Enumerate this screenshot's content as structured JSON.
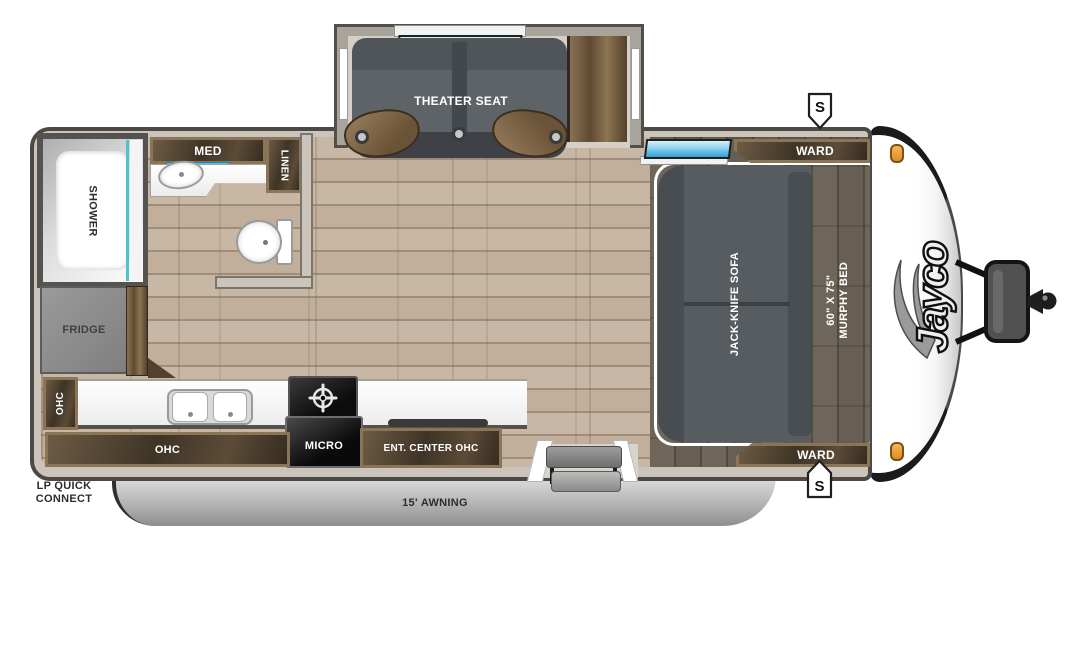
{
  "meta": {
    "title": "Jayco travel trailer floor plan"
  },
  "brand": {
    "logo": "Jayco"
  },
  "exterior": {
    "awning_label": "15' AWNING",
    "lp_line1": "LP QUICK",
    "lp_line2": "CONNECT",
    "stabilizer_top": "S",
    "stabilizer_bottom": "S"
  },
  "slideout": {
    "theater_seat": "THEATER SEAT"
  },
  "bathroom": {
    "shower": "SHOWER",
    "med": "MED",
    "linen": "LINEN"
  },
  "kitchen": {
    "fridge": "FRIDGE",
    "ohc_side": "OHC",
    "ohc_lower": "OHC",
    "micro": "MICRO",
    "ent_center": "ENT. CENTER OHC"
  },
  "bedroom": {
    "ward_top": "WARD",
    "ward_bottom": "WARD",
    "sofa": "JACK-KNIFE SOFA",
    "murphy_size": "60\" X 75\"",
    "murphy_bed": "MURPHY BED"
  },
  "colors": {
    "floor": "#c8b7a5",
    "deck": "#675f54",
    "wood_dark": "#3e3426",
    "seat_gray": "#5d6367",
    "window_blue": "#2f9fd7",
    "marker_orange": "#f0a13c",
    "awning_silver": "#c2c2c2",
    "wall": "#cac4bb"
  }
}
